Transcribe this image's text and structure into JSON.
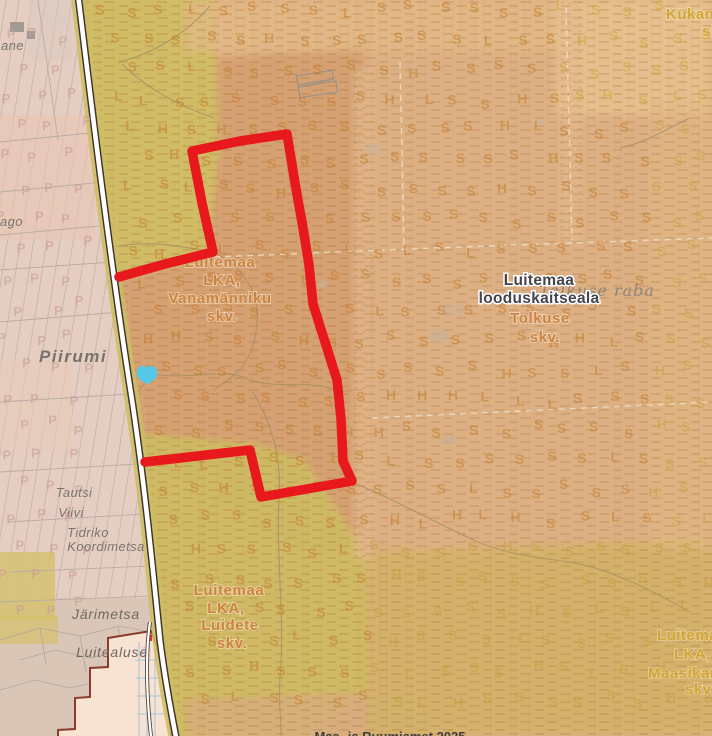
{
  "map": {
    "labels": {
      "title": {
        "line1": "Luitemaa",
        "line2": "looduskaitseala"
      },
      "raba": "Tolkuse raba",
      "tolkuse": {
        "line1": "Tolkuse",
        "line2": "skv."
      },
      "vanamanniku": {
        "l1": "Luitemaa",
        "l2": "LKA,",
        "l3": "Vanamänniku",
        "l4": "skv."
      },
      "luidete": {
        "l1": "Luitemaa",
        "l2": "LKA,",
        "l3": "Luidete",
        "l4": "skv."
      },
      "maasika": {
        "l1": "Luitema",
        "l2": "LKA,",
        "l3": "Maasikam",
        "l4": "skv."
      },
      "kukan": {
        "l1": "Kükan",
        "l2": "sk"
      },
      "places": {
        "ane": "ane",
        "ago": "ago",
        "piirumi": "Piirumi",
        "tautsi": "Tautsi",
        "viivi": "Viivi",
        "tidriko1": "Tidriko",
        "tidriko2": "Koordimetsa",
        "jarimetsa": "Järimetsa",
        "luitealuse": "Luitealuse"
      },
      "attribution": "Maa- ja Ruumiamet 2025"
    },
    "colors": {
      "boundary_red": "#e8191d",
      "water": "#55c8ea",
      "road_fill": "#ffffff",
      "road_casing": "#41332b",
      "olive": "#d1bc66",
      "tan_dark": "#d5a172",
      "tan_light": "#ddb083",
      "pink_parcels": "#e5cec1",
      "settlement_fill": "#f8e2d2",
      "settlement_border": "#8a3b2c"
    },
    "letter_fields": [
      {
        "name": "forest-soil-symbols",
        "side": "right",
        "seed": 11,
        "x0": 100,
        "y0": 14,
        "x1": 708,
        "y1": 730,
        "dx": 31,
        "dy": 30,
        "jitter": 5,
        "size": 14,
        "opacity": 0.55,
        "default_color": "#c57f31",
        "glyphs": [
          [
            "S",
            0.78
          ],
          [
            "L",
            0.12
          ],
          [
            "H",
            0.1
          ]
        ],
        "color_zones": [
          {
            "x": 555,
            "y": 0,
            "w": 157,
            "h": 112,
            "color": "#d2a63a"
          },
          {
            "x": 368,
            "y": 548,
            "w": 344,
            "h": 188,
            "color": "#c7a040"
          },
          {
            "x": 648,
            "y": 112,
            "w": 64,
            "h": 436,
            "color": "#cf9f45"
          }
        ]
      },
      {
        "name": "parcel-symbols",
        "side": "left",
        "seed": 4,
        "x0": 6,
        "y0": 40,
        "x1": 92,
        "y1": 620,
        "dx": 31,
        "dy": 30,
        "jitter": 6,
        "size": 13,
        "opacity": 0.6,
        "default_color": "#c89d94",
        "glyphs": [
          [
            "P",
            1
          ]
        ],
        "color_zones": []
      }
    ]
  }
}
